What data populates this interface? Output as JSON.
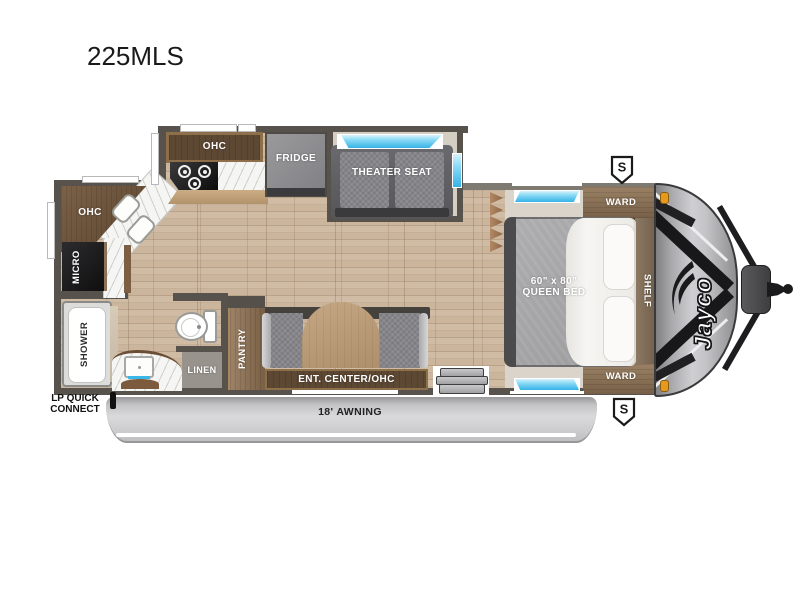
{
  "title": "225MLS",
  "colors": {
    "wall": "#57524c",
    "wood-floor": "#c8b39a",
    "carpet": "#dbd4ca",
    "cabinet-dark": "#5d4834",
    "cabinet-trim": "#8d7049",
    "wood-tall": "#8a7156",
    "gray-appliance": "#8e8e90",
    "seat-gray": "#7e7e82",
    "window-blue": "#45bdec",
    "awning-gray": "#c6c6c8",
    "cap-gray": "#b4b4b7",
    "marker-orange": "#e59a1e"
  },
  "rooms": {
    "kitchen": {
      "ohc": "OHC",
      "fridge": "FRIDGE"
    },
    "rear_kitchen": {
      "ohc": "OHC",
      "micro": "MICRO"
    },
    "bathroom": {
      "shower": "SHOWER",
      "linen": "LINEN"
    },
    "living": {
      "theater_seat": "THEATER SEAT",
      "pantry": "PANTRY",
      "ent_center": "ENT. CENTER/OHC"
    },
    "bedroom": {
      "ward_top": "WARD",
      "ward_bottom": "WARD",
      "shelf": "SHELF",
      "bed_size": "60\" x 80\"",
      "bed_type": "QUEEN BED"
    }
  },
  "exterior": {
    "awning": "18' AWNING",
    "lp_quick_connect_line1": "LP QUICK",
    "lp_quick_connect_line2": "CONNECT",
    "speaker_top": "S",
    "speaker_bottom": "S",
    "brand_logo": "Jayco"
  }
}
